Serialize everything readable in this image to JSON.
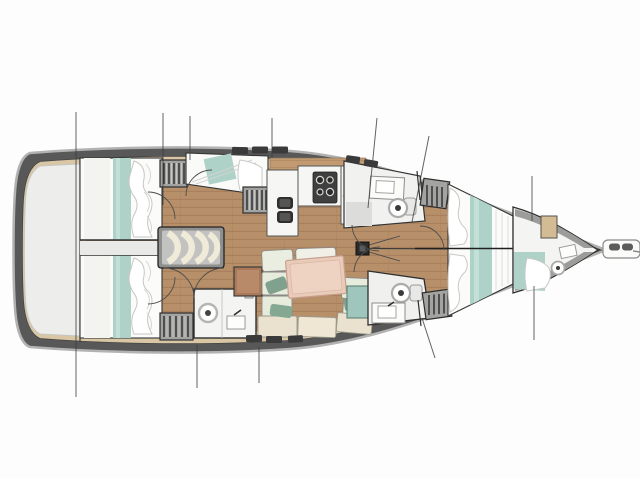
{
  "plan": {
    "vessel": "Sailing yacht interior layout plan, bow pointing right",
    "orientation": "bow right, stern left",
    "areas": [
      {
        "id": "stern-platform",
        "label": "Stern transom area"
      },
      {
        "id": "aft-cabin-port",
        "label": "Aft double cabin (port, top) with teal-striped berth"
      },
      {
        "id": "aft-cabin-starboard",
        "label": "Aft double cabin (starboard, bottom) with teal-striped berth"
      },
      {
        "id": "aft-head",
        "label": "Aft bathroom with round washbasin"
      },
      {
        "id": "companionway",
        "label": "Companionway entry steps"
      },
      {
        "id": "mid-cabin",
        "label": "Midship berth cabin with louvered locker"
      },
      {
        "id": "galley",
        "label": "Galley with twin sinks and stove"
      },
      {
        "id": "salon",
        "label": "Salon with U-shaped settee and table"
      },
      {
        "id": "head-forward-top",
        "label": "Forward bathroom (top) with toilet and basin"
      },
      {
        "id": "head-forward-bottom",
        "label": "Forward bathroom (bottom) with toilet, basin and teal shower"
      },
      {
        "id": "mast",
        "label": "Mast post on centerline"
      },
      {
        "id": "owner-cabin",
        "label": "Forward owner cabin with centerline-split double berth"
      },
      {
        "id": "forepeak",
        "label": "Forepeak crew compartment with berth and toilet"
      },
      {
        "id": "bowsprit",
        "label": "Bowsprit with anchor roller"
      },
      {
        "id": "rigging-lines",
        "label": "Thin rigging / station lines crossing the hull"
      }
    ],
    "colors": {
      "hull_dark": "#585858",
      "hull_edge_light": "#b2b2b2",
      "deck_band_tan": "#d8c6a4",
      "floor_wood": "#b7906a",
      "bedding_teal": "#aed2c7",
      "cushion_sage": "#e7ebdc",
      "bench_cream": "#eae2cf",
      "table_salmon": "#e9cbb9",
      "fixture_white": "#f6f6f4",
      "locker_gray": "#a3a3a1",
      "stern_gray": "#ededec",
      "shower_teal": "#9fc6bc",
      "pillow_accent_green": "#7fa18d"
    },
    "counts": {
      "cabins": 5,
      "heads": 4,
      "berth_teal_stripes": 4
    }
  }
}
